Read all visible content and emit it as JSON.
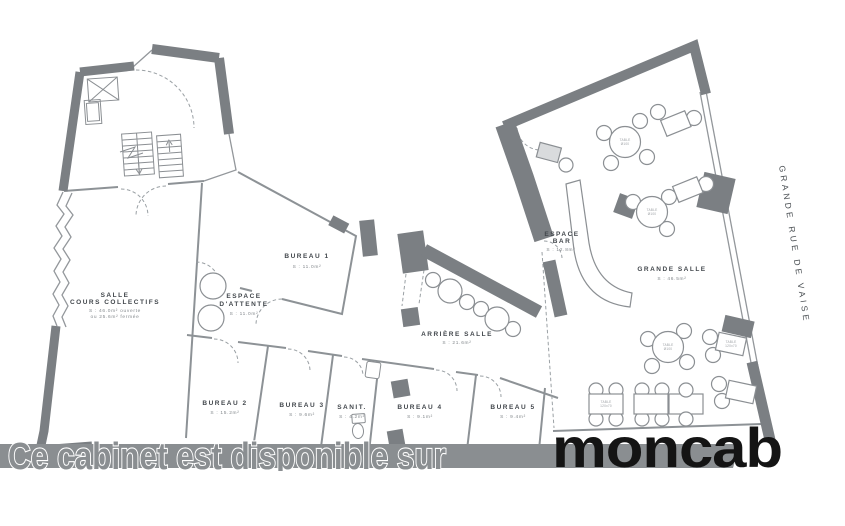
{
  "watermark": {
    "text": "Ce cabinet est disponible sur",
    "brand": "moncab"
  },
  "street": {
    "label": "GRANDE RUE DE VAISE"
  },
  "rooms": {
    "salle": {
      "name": "SALLE",
      "name2": "COURS COLLECTIFS",
      "area": "S : 46.0m² ouverte",
      "area2": "ou 25.6m² fermée"
    },
    "attente": {
      "name": "ESPACE",
      "name2": "D'ATTENTE",
      "area": "S : 11.0m²"
    },
    "bureau1": {
      "name": "BUREAU 1",
      "area": "S : 11.0m²"
    },
    "arriere": {
      "name": "ARRIÈRE SALLE",
      "area": "S : 21.6m²"
    },
    "bureau2": {
      "name": "BUREAU 2",
      "area": "S : 15.2m²"
    },
    "bureau3": {
      "name": "BUREAU 3",
      "area": "S : 9.6m²"
    },
    "sanit": {
      "name": "SANIT.",
      "area": "S : 4.2m²"
    },
    "bureau4": {
      "name": "BUREAU 4",
      "area": "S : 9.1m²"
    },
    "bureau5": {
      "name": "BUREAU 5",
      "area": "S : 9.4m²"
    },
    "bar": {
      "name": "ESPACE",
      "name2": "BAR",
      "area": "S : 12.8m²"
    },
    "grande": {
      "name": "GRANDE SALLE",
      "area": "S : 46.5m²"
    }
  },
  "furniture": {
    "table_line1": "TABLE",
    "round_table_line2": "Ø100",
    "rect_table_line2": "120x70"
  },
  "colors": {
    "wall": "#7b7f83",
    "line": "#93979b",
    "label": "#42474c",
    "area_text": "#83888c",
    "watermark_band": "#8a8e91",
    "brand": "#141414",
    "background": "#ffffff"
  }
}
